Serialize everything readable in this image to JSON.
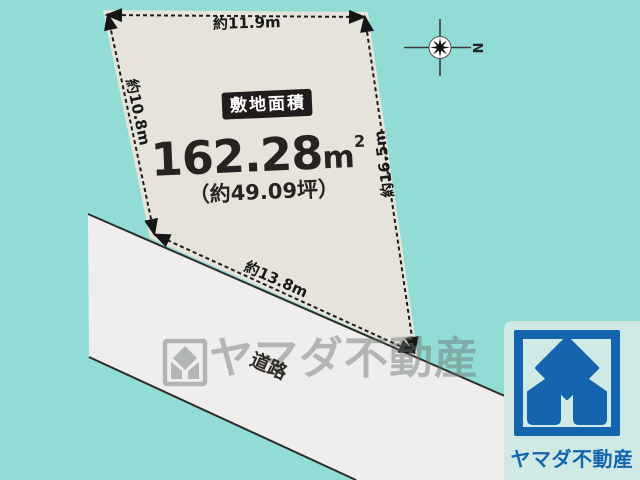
{
  "diagram": {
    "site": {
      "badge_label": "敷地面積",
      "area_value": "162.28",
      "area_unit": "m",
      "area_superscript": "2",
      "area_tsubo": "（約49.09坪）",
      "dimension_top": "約11.9m",
      "dimension_left": "約10.8m",
      "dimension_right": "約16.5m",
      "dimension_bottom": "約13.8m"
    },
    "road_label": "道路",
    "compass_north": "N"
  },
  "watermark_text": "ヤマダ不動産",
  "brand": {
    "company_name": "ヤマダ不動産"
  },
  "colors": {
    "background": "#92dcd6",
    "plot_fill": "#e6e4da",
    "road_fill": "#efeeec",
    "badge_bg": "#221d1b",
    "brand_blue": "#1565ae",
    "logo_card_bg": "#cfeae5",
    "watermark_gray": "#69736f"
  }
}
